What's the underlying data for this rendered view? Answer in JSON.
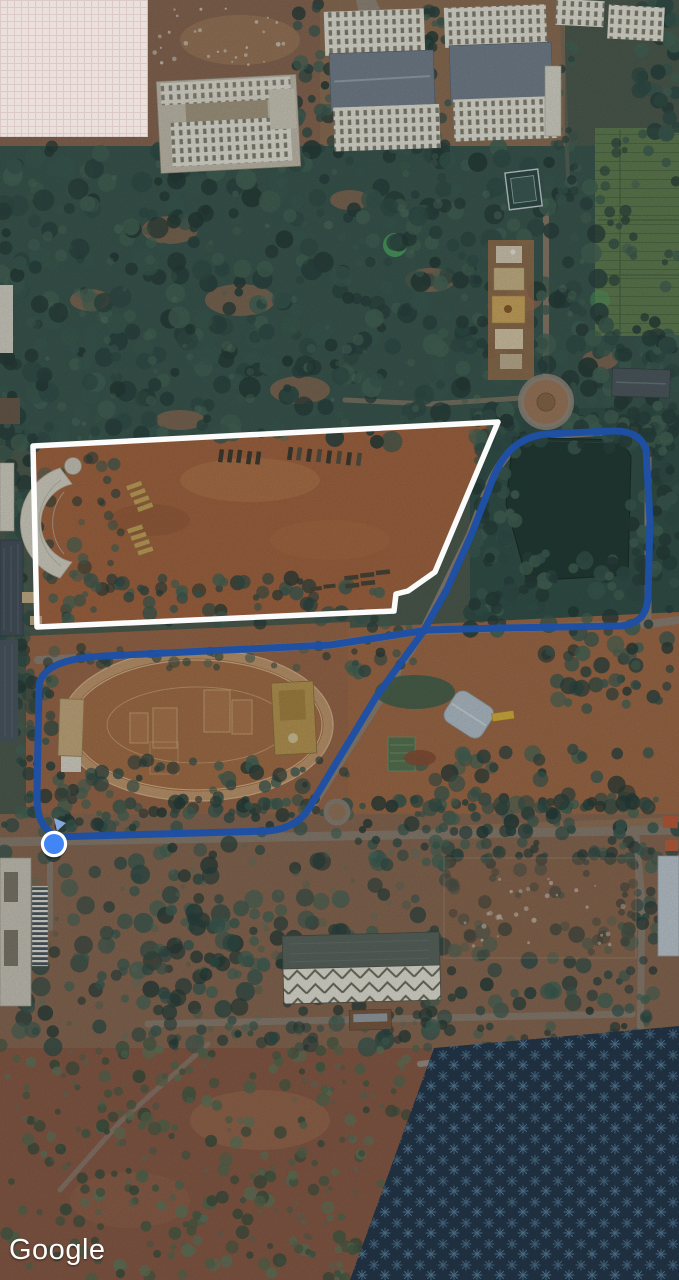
{
  "app": {
    "watermark": "Google"
  },
  "map": {
    "colors": {
      "route": "#1d4fa6",
      "location_dot": "#4285f4",
      "location_dot_ring": "#ffffff",
      "field_outline": "#ffffff"
    },
    "overlays": {
      "route_path": "M 54 837 L 160 834 L 268 831 Q 300 828 312 803 L 376 697 L 423 632 L 447 589 L 472 533 L 489 489 Q 499 459 514 447 Q 527 436 547 434 L 612 431 Q 639 430 646 449 L 650 521 L 648 597 Q 647 623 621 626 L 500 628 L 428 630 L 330 645 L 104 656 Q 42 659 39 686 L 37 795 Q 37 821 47 829 Q 51 833 54 837 Z",
      "field_outline_points": "33,446 498,422 435,572 408,591 396,594 394,611 37,627",
      "location_dot": {
        "cx": 54,
        "cy": 844,
        "r": 10
      },
      "direction_hint_points": "54,818 66,823 57,831"
    }
  }
}
